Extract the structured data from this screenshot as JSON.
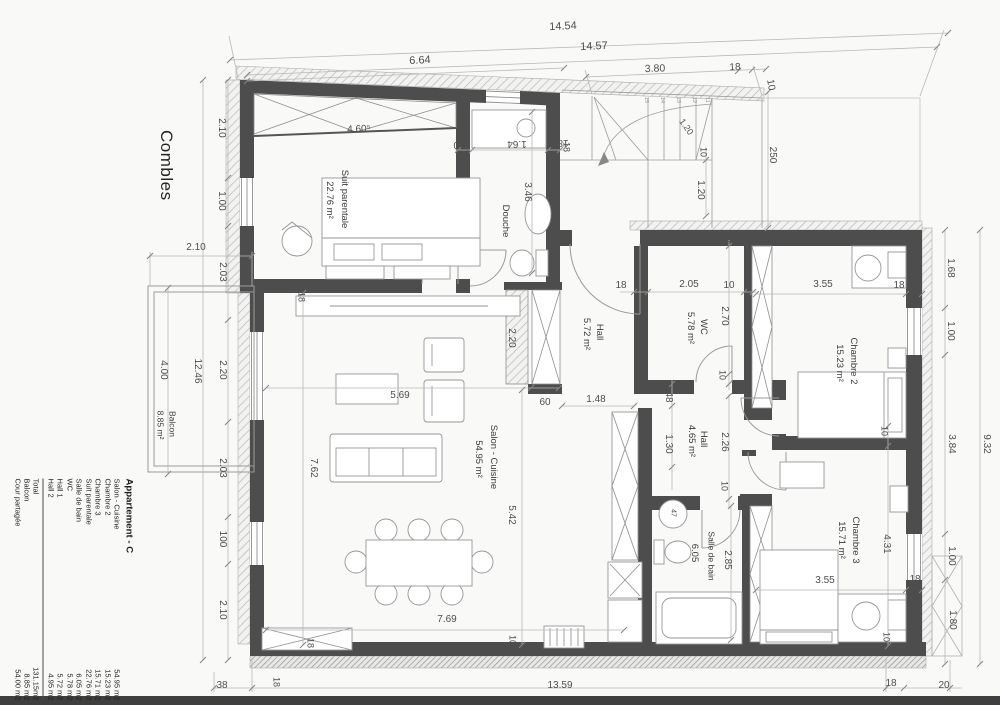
{
  "title": "Combles",
  "legend": {
    "title": "Appartement - C",
    "rows": [
      [
        "Salon - Cuisine",
        "54.95 m2"
      ],
      [
        "Chambre 2",
        "15.23 m2"
      ],
      [
        "Chambre 3",
        "15.71 m2"
      ],
      [
        "Suit parentale",
        "22.76 m2"
      ],
      [
        "Salle de bain",
        "6.05 m2"
      ],
      [
        "WC",
        "5.78 m2"
      ],
      [
        "Hall 1",
        "5.72 m2"
      ],
      [
        "Hall 2",
        "4.95 m2"
      ]
    ],
    "totals": [
      [
        "Total",
        "131.15m2"
      ],
      [
        "Balcon",
        "8.85 m2"
      ],
      [
        "Cour partagée",
        "54.00 m2"
      ]
    ]
  },
  "plan_labels": [
    {
      "t": "14.54",
      "x": 563,
      "y": 27,
      "r": -2.5,
      "s": 11,
      "k": "dim"
    },
    {
      "t": "14.57",
      "x": 594,
      "y": 47,
      "r": -2.5,
      "s": 11,
      "k": "dim"
    },
    {
      "t": "6.64",
      "x": 420,
      "y": 61,
      "r": -2.5,
      "s": 11,
      "k": "dim"
    },
    {
      "t": "3.80",
      "x": 655,
      "y": 69,
      "r": -2,
      "s": 10.5,
      "k": "dim"
    },
    {
      "t": "18",
      "x": 735,
      "y": 68,
      "r": -2,
      "s": 10,
      "k": "dim"
    },
    {
      "t": "10",
      "x": 770,
      "y": 85,
      "r": 80,
      "s": 10,
      "k": "dim"
    },
    {
      "t": "2.10",
      "x": 221,
      "y": 128,
      "r": 90,
      "s": 10,
      "k": "dim"
    },
    {
      "t": "1.00",
      "x": 221,
      "y": 201,
      "r": 90,
      "s": 10,
      "k": "dim"
    },
    {
      "t": "2.03",
      "x": 222,
      "y": 272,
      "r": 90,
      "s": 10,
      "k": "dim"
    },
    {
      "t": "2.20",
      "x": 222,
      "y": 370,
      "r": 90,
      "s": 10,
      "k": "dim"
    },
    {
      "t": "2.03",
      "x": 222,
      "y": 468,
      "r": 90,
      "s": 10,
      "k": "dim"
    },
    {
      "t": "100",
      "x": 222,
      "y": 539,
      "r": 90,
      "s": 10,
      "k": "dim"
    },
    {
      "t": "2.10",
      "x": 222,
      "y": 610,
      "r": 90,
      "s": 10,
      "k": "dim"
    },
    {
      "t": "12.46",
      "x": 197,
      "y": 371,
      "r": 90,
      "s": 10,
      "k": "dim"
    },
    {
      "t": "4.00",
      "x": 163,
      "y": 370,
      "r": 90,
      "s": 10,
      "k": "dim"
    },
    {
      "t": "2.10",
      "x": 196,
      "y": 248,
      "r": 0,
      "s": 10,
      "k": "dim"
    },
    {
      "t": "Balcon",
      "x": 172,
      "y": 424,
      "r": 90,
      "s": 8.5,
      "k": "room"
    },
    {
      "t": "8.85 m²",
      "x": 160,
      "y": 425,
      "r": 90,
      "s": 8.5,
      "k": "room"
    },
    {
      "t": "Suit parentale",
      "x": 344,
      "y": 199,
      "r": 90,
      "s": 9.5,
      "k": "room"
    },
    {
      "t": "22.76 m²",
      "x": 329,
      "y": 200,
      "r": 90,
      "s": 9.5,
      "k": "room"
    },
    {
      "t": "4.60⁵",
      "x": 359,
      "y": 130,
      "r": -2,
      "s": 10,
      "k": "dim"
    },
    {
      "t": "18",
      "x": 301,
      "y": 297,
      "r": 90,
      "s": 9,
      "k": "dim"
    },
    {
      "t": "Douche",
      "x": 505,
      "y": 221,
      "r": 90,
      "s": 9.5,
      "k": "room"
    },
    {
      "t": "3.46",
      "x": 527,
      "y": 192,
      "r": 90,
      "s": 10,
      "k": "dim"
    },
    {
      "t": "10",
      "x": 459,
      "y": 144,
      "r": 180,
      "s": 10,
      "k": "dim"
    },
    {
      "t": "1.64",
      "x": 517,
      "y": 143,
      "r": 180,
      "s": 10,
      "k": "dim"
    },
    {
      "t": "18",
      "x": 563,
      "y": 142,
      "r": 180,
      "s": 10,
      "k": "dim"
    },
    {
      "t": "250",
      "x": 772,
      "y": 155,
      "r": 90,
      "s": 10,
      "k": "dim"
    },
    {
      "t": "10",
      "x": 703,
      "y": 152,
      "r": 90,
      "s": 9,
      "k": "dim"
    },
    {
      "t": "1.20",
      "x": 700,
      "y": 190,
      "r": 90,
      "s": 10,
      "k": "dim"
    },
    {
      "t": "1.20",
      "x": 686,
      "y": 127,
      "r": 55,
      "s": 9,
      "k": "dim"
    },
    {
      "t": "18",
      "x": 566,
      "y": 147,
      "r": 90,
      "s": 9,
      "k": "dim"
    },
    {
      "t": "15",
      "x": 645,
      "y": 100,
      "r": 90,
      "s": 5.5,
      "k": "tiny"
    },
    {
      "t": "14",
      "x": 661,
      "y": 100,
      "r": 90,
      "s": 5.5,
      "k": "tiny"
    },
    {
      "t": "13",
      "x": 677,
      "y": 100,
      "r": 90,
      "s": 5.5,
      "k": "tiny"
    },
    {
      "t": "12",
      "x": 693,
      "y": 100,
      "r": 90,
      "s": 5.5,
      "k": "tiny"
    },
    {
      "t": "11",
      "x": 706,
      "y": 100,
      "r": 90,
      "s": 5.5,
      "k": "tiny"
    },
    {
      "t": "Hall",
      "x": 599,
      "y": 332,
      "r": 90,
      "s": 9.5,
      "k": "room"
    },
    {
      "t": "5.72 m²",
      "x": 586,
      "y": 334,
      "r": 90,
      "s": 9.5,
      "k": "room"
    },
    {
      "t": "1.48",
      "x": 596,
      "y": 400,
      "r": 0,
      "s": 10,
      "k": "dim"
    },
    {
      "t": "60",
      "x": 545,
      "y": 403,
      "r": 0,
      "s": 10,
      "k": "dim"
    },
    {
      "t": "2.20",
      "x": 511,
      "y": 338,
      "r": 90,
      "s": 10,
      "k": "dim"
    },
    {
      "t": "WC",
      "x": 703,
      "y": 327,
      "r": 90,
      "s": 9.5,
      "k": "room"
    },
    {
      "t": "5.78 m²",
      "x": 690,
      "y": 328,
      "r": 90,
      "s": 9.5,
      "k": "room"
    },
    {
      "t": "18",
      "x": 621,
      "y": 286,
      "r": 0,
      "s": 10,
      "k": "dim"
    },
    {
      "t": "2.05",
      "x": 689,
      "y": 285,
      "r": 0,
      "s": 10,
      "k": "dim"
    },
    {
      "t": "10",
      "x": 729,
      "y": 286,
      "r": 0,
      "s": 10,
      "k": "dim"
    },
    {
      "t": "2.70",
      "x": 724,
      "y": 316,
      "r": 90,
      "s": 10,
      "k": "dim"
    },
    {
      "t": "5",
      "x": 726,
      "y": 243,
      "r": 90,
      "s": 8,
      "k": "dim"
    },
    {
      "t": "10",
      "x": 722,
      "y": 375,
      "r": 90,
      "s": 9,
      "k": "dim"
    },
    {
      "t": "48",
      "x": 668,
      "y": 397,
      "r": 90,
      "s": 10,
      "k": "dim"
    },
    {
      "t": "Hall",
      "x": 703,
      "y": 439,
      "r": 90,
      "s": 9.5,
      "k": "room"
    },
    {
      "t": "4.65 m²",
      "x": 691,
      "y": 441,
      "r": 90,
      "s": 9.5,
      "k": "room"
    },
    {
      "t": "1.30",
      "x": 668,
      "y": 444,
      "r": 90,
      "s": 10,
      "k": "dim"
    },
    {
      "t": "2.26",
      "x": 724,
      "y": 442,
      "r": 90,
      "s": 10,
      "k": "dim"
    },
    {
      "t": "10",
      "x": 724,
      "y": 486,
      "r": 90,
      "s": 9,
      "k": "dim"
    },
    {
      "t": "Salon - Cuisine",
      "x": 493,
      "y": 457,
      "r": 90,
      "s": 9.5,
      "k": "room"
    },
    {
      "t": "54.95 m²",
      "x": 478,
      "y": 459,
      "r": 90,
      "s": 9.5,
      "k": "room"
    },
    {
      "t": "5.69",
      "x": 400,
      "y": 396,
      "r": 0,
      "s": 10,
      "k": "dim"
    },
    {
      "t": "7.62",
      "x": 313,
      "y": 468,
      "r": 90,
      "s": 10,
      "k": "dim"
    },
    {
      "t": "5.42",
      "x": 511,
      "y": 515,
      "r": 90,
      "s": 10,
      "k": "dim"
    },
    {
      "t": "7.69",
      "x": 447,
      "y": 620,
      "r": 0,
      "s": 10,
      "k": "dim"
    },
    {
      "t": "10",
      "x": 512,
      "y": 640,
      "r": 90,
      "s": 9,
      "k": "dim"
    },
    {
      "t": "18",
      "x": 310,
      "y": 643,
      "r": 90,
      "s": 9,
      "k": "dim"
    },
    {
      "t": "Chambre 2",
      "x": 853,
      "y": 361,
      "r": 90,
      "s": 9.5,
      "k": "room"
    },
    {
      "t": "15.23 m²",
      "x": 839,
      "y": 363,
      "r": 90,
      "s": 9.5,
      "k": "room"
    },
    {
      "t": "3.55",
      "x": 823,
      "y": 285,
      "r": 0,
      "s": 10,
      "k": "dim"
    },
    {
      "t": "18",
      "x": 899,
      "y": 286,
      "r": 0,
      "s": 10,
      "k": "dim"
    },
    {
      "t": "10",
      "x": 884,
      "y": 431,
      "r": 90,
      "s": 9,
      "k": "dim"
    },
    {
      "t": "Salle de bain",
      "x": 711,
      "y": 556,
      "r": 90,
      "s": 8.5,
      "k": "room"
    },
    {
      "t": "6.05",
      "x": 694,
      "y": 553,
      "r": 90,
      "s": 9.5,
      "k": "room"
    },
    {
      "t": "2.85",
      "x": 727,
      "y": 560,
      "r": 90,
      "s": 10,
      "k": "dim"
    },
    {
      "t": "47",
      "x": 673,
      "y": 513,
      "r": 90,
      "s": 7,
      "k": "dim"
    },
    {
      "t": "Chambre 3",
      "x": 855,
      "y": 540,
      "r": 90,
      "s": 9.5,
      "k": "room"
    },
    {
      "t": "15.71 m²",
      "x": 841,
      "y": 540,
      "r": 90,
      "s": 9.5,
      "k": "room"
    },
    {
      "t": "4.31",
      "x": 886,
      "y": 544,
      "r": 90,
      "s": 10,
      "k": "dim"
    },
    {
      "t": "3.55",
      "x": 825,
      "y": 581,
      "r": 0,
      "s": 10,
      "k": "dim"
    },
    {
      "t": "18",
      "x": 915,
      "y": 580,
      "r": 0,
      "s": 10,
      "k": "dim"
    },
    {
      "t": "10",
      "x": 886,
      "y": 637,
      "r": 90,
      "s": 9,
      "k": "dim"
    },
    {
      "t": "1.68",
      "x": 950,
      "y": 268,
      "r": 90,
      "s": 10,
      "k": "dim"
    },
    {
      "t": "1.00",
      "x": 950,
      "y": 331,
      "r": 90,
      "s": 10,
      "k": "dim"
    },
    {
      "t": "3.84",
      "x": 951,
      "y": 444,
      "r": 90,
      "s": 10,
      "k": "dim"
    },
    {
      "t": "1.00",
      "x": 951,
      "y": 556,
      "r": 90,
      "s": 10,
      "k": "dim"
    },
    {
      "t": "1.80",
      "x": 952,
      "y": 620,
      "r": 90,
      "s": 10,
      "k": "dim"
    },
    {
      "t": "9.32",
      "x": 986,
      "y": 444,
      "r": 90,
      "s": 10,
      "k": "dim"
    },
    {
      "t": "38",
      "x": 222,
      "y": 686,
      "r": 0,
      "s": 10,
      "k": "dim"
    },
    {
      "t": "18",
      "x": 276,
      "y": 682,
      "r": 90,
      "s": 9,
      "k": "dim"
    },
    {
      "t": "13.59",
      "x": 560,
      "y": 686,
      "r": 0,
      "s": 10,
      "k": "dim"
    },
    {
      "t": "18",
      "x": 891,
      "y": 684,
      "r": 0,
      "s": 10,
      "k": "dim"
    },
    {
      "t": "20",
      "x": 944,
      "y": 686,
      "r": 0,
      "s": 10,
      "k": "dim"
    }
  ]
}
